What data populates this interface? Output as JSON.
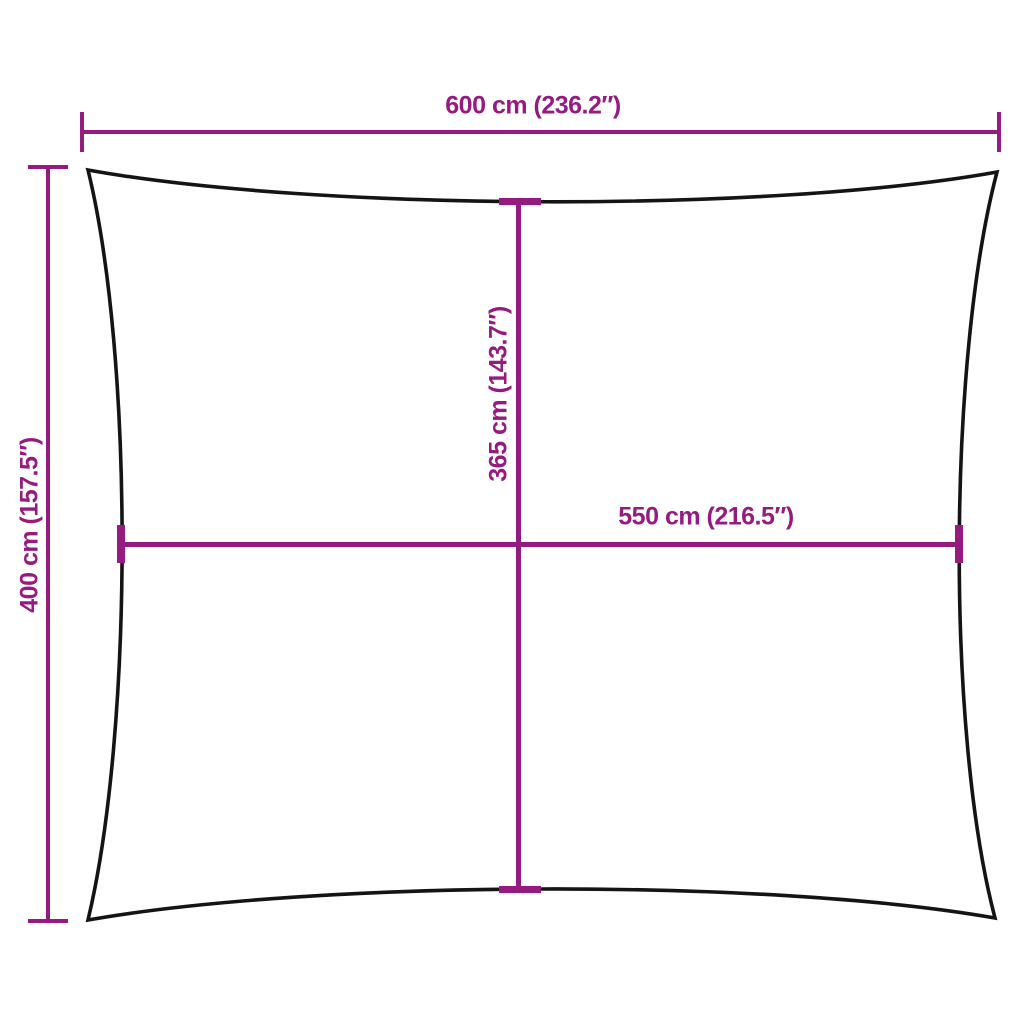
{
  "diagram": {
    "colors": {
      "accent": "#951b81",
      "outline": "#141414",
      "background": "#ffffff"
    },
    "shape": "rectangular-sunshade-sail-outline",
    "dimensions": {
      "top_width": {
        "cm": 600,
        "inches": 236.2,
        "label": "600 cm (236.2″)"
      },
      "left_height": {
        "cm": 400,
        "inches": 157.5,
        "label": "400 cm (157.5″)"
      },
      "center_height": {
        "cm": 365,
        "inches": 143.7,
        "label": "365 cm (143.7″)"
      },
      "center_width": {
        "cm": 550,
        "inches": 216.5,
        "label": "550 cm (216.5″)"
      }
    }
  }
}
